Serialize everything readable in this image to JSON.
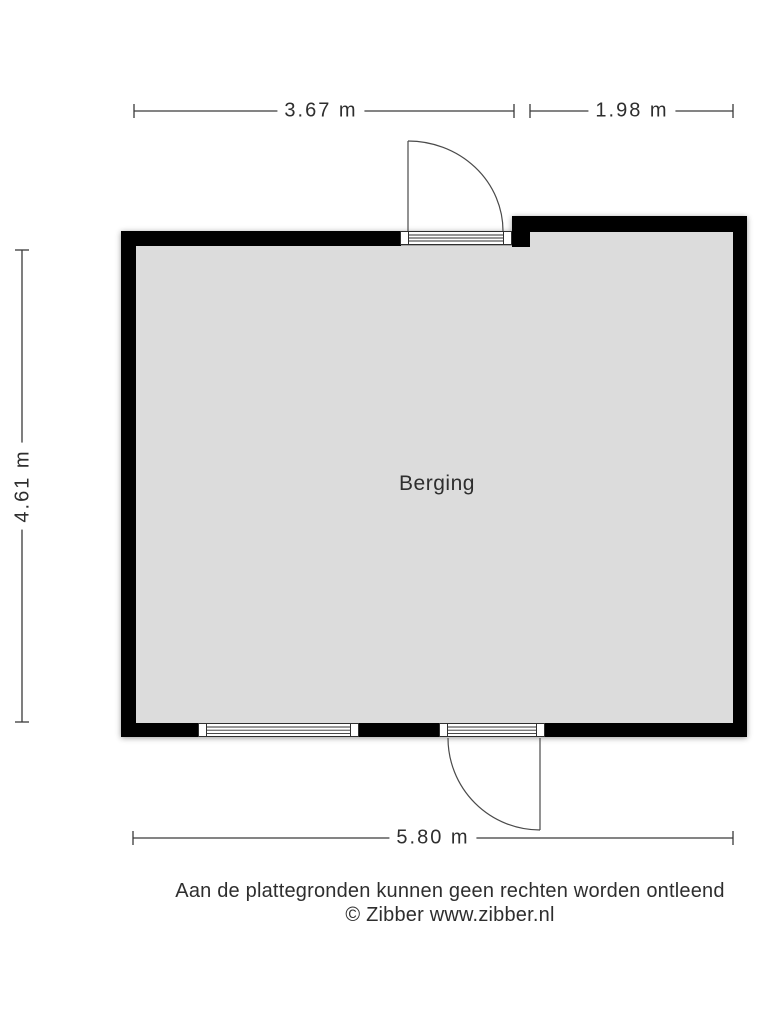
{
  "floorplan": {
    "room_label": "Berging",
    "dimensions": {
      "top_left": "3.67 m",
      "top_right": "1.98 m",
      "left": "4.61 m",
      "bottom": "5.80 m"
    },
    "footer": {
      "disclaimer": "Aan de plattegronden kunnen geen rechten worden ontleend",
      "credit": "© Zibber www.zibber.nl"
    },
    "colors": {
      "wall": "#000000",
      "floor": "#dcdcdc",
      "frame": "#2f2f2f",
      "line": "#3a3a3a",
      "text": "#2e2e2e",
      "background": "#ffffff"
    }
  }
}
